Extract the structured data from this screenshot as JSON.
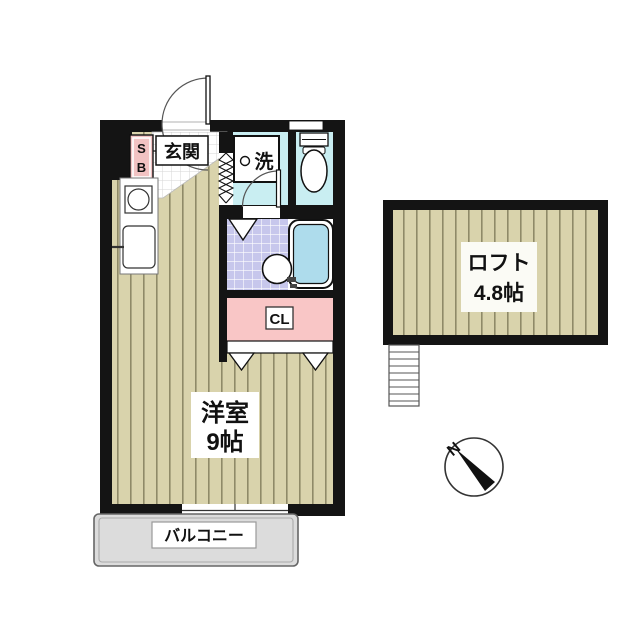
{
  "plan": {
    "unit": {
      "entrance_label": "玄関",
      "shoe_box_line1": "S",
      "shoe_box_line2": "B",
      "washer_label": "洗",
      "closet_label": "CL",
      "main_room_name": "洋室",
      "main_room_size": "9帖",
      "balcony_label": "バルコニー"
    },
    "loft": {
      "name": "ロフト",
      "size": "4.8帖"
    },
    "compass": {
      "label": "N"
    },
    "colors": {
      "wall": "#141414",
      "wood_floor": "#d9d3ac",
      "wood_stripe": "#8f8a68",
      "wet_room": "#c9eef2",
      "bath_tile": "#c7c7ec",
      "tub_water": "#aedcec",
      "closet_pink": "#f9c6c6",
      "shoebox_pink": "#f2c3c3",
      "balcony_gray": "#dcdcdc"
    }
  }
}
